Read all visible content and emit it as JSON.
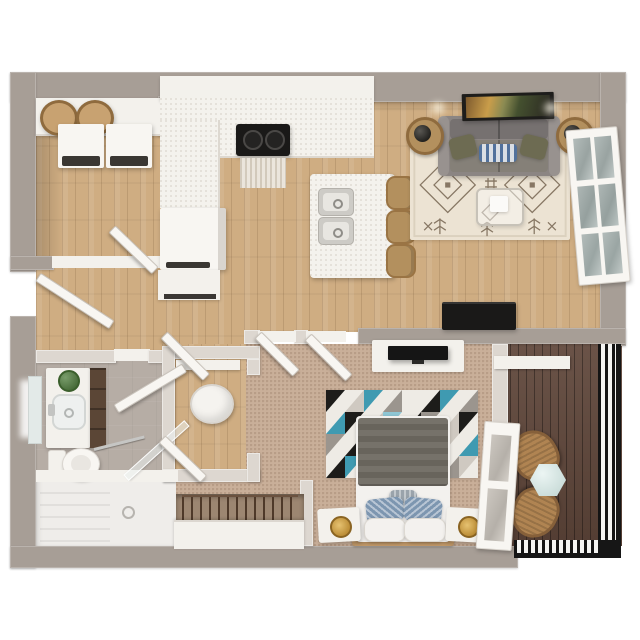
{
  "scene": {
    "type": "3d-floor-plan-top-view",
    "label": "One-bedroom apartment 3D floor plan render, bird's-eye view",
    "background": "#ffffff"
  },
  "palette": {
    "outer_wall": "#a79e96",
    "partition_wall": "#ddd7d0",
    "white_surface": "#f3f1ec",
    "door_white": "#f8f6f2",
    "wood_floor": "#cfad82",
    "carpet": "#c9af99",
    "bathroom_floor": "#b6ada5",
    "shower_white": "#efedea",
    "balcony_deck": "#5f463a",
    "railing_black": "#161616",
    "counter_white": "#f4f2ed",
    "appliance_black": "#1a1918",
    "appliance_front": "#3a3733",
    "rattan_tan": "#b3905e",
    "basket_tan": "#c8a271",
    "sofa_gray": "#8b8583",
    "sofa_back": "#767170",
    "sofa_seat": "#858078",
    "pillow_olive": "#6d6b52",
    "rug_cream": "#ece3d3",
    "rug_geo_base": "#eeebe5",
    "bed_blanket_gray": "#6f6a62",
    "pillow_blue": "#7d96b0",
    "pillow_white": "#f3f1ee",
    "lamp_gold": "#c79b43",
    "cabinet_brown": "#5b4636",
    "plant_green": "#4c7c39",
    "mint_table": "#cfe6e2",
    "bed_frame_tan": "#c09868",
    "mirror_glass": "#e3eae8",
    "tv_black": "#151515",
    "wardrobe_recess": "#9c8671",
    "deck_chair_tan": "#b08452"
  },
  "rooms": {
    "kitchen": {
      "label": "Kitchen",
      "floor": "wood",
      "items": [
        "upper-cabinets",
        "counter-run",
        "cooktop",
        "vent-panel",
        "refrigerator",
        "base-cabinet",
        "island-with-double-sink",
        "bar-stools-x3"
      ]
    },
    "living_room": {
      "label": "Living room",
      "floor": "wood",
      "items": [
        "sofa",
        "olive-pillows-x2",
        "striped-pillow",
        "boho-rug",
        "coffee-table",
        "side-tables-with-lamps-x2",
        "wall-art",
        "french-door",
        "ceiling-spotlights-x2"
      ]
    },
    "bedroom": {
      "label": "Bedroom",
      "floor": "carpet",
      "items": [
        "bed",
        "blue-pillows-x2",
        "white-pillows-x2",
        "lumbar-pillow",
        "geometric-rug",
        "nightstands-with-lamps-x2",
        "dresser",
        "tv",
        "wardrobe-with-hangers",
        "media-console"
      ]
    },
    "bathroom": {
      "label": "Bathroom",
      "floor": "tile",
      "items": [
        "vanity-sink",
        "mirror",
        "plant",
        "brown-shelf-cabinet",
        "toilet",
        "bathtub-shower",
        "glass-panel",
        "towel-bar"
      ]
    },
    "laundry": {
      "label": "Laundry closet",
      "items": [
        "washer",
        "dryer",
        "shelf",
        "woven-baskets-x2"
      ]
    },
    "closet": {
      "label": "Walk-in closet",
      "items": [
        "laundry-basket",
        "shelf"
      ]
    },
    "hallway": {
      "label": "Hallway",
      "floor": "wood",
      "items": [
        "open-doors"
      ]
    },
    "entry": {
      "label": "Entry",
      "items": [
        "front-door"
      ]
    },
    "balcony": {
      "label": "Balcony",
      "floor": "deck",
      "items": [
        "rattan-chairs-x2",
        "hex-side-table",
        "black-railing",
        "balcony-door"
      ]
    }
  },
  "counts": {
    "open_doors": 7,
    "bar_stools": 3,
    "balcony_chairs": 2,
    "lamps": 4,
    "baskets": 2
  }
}
